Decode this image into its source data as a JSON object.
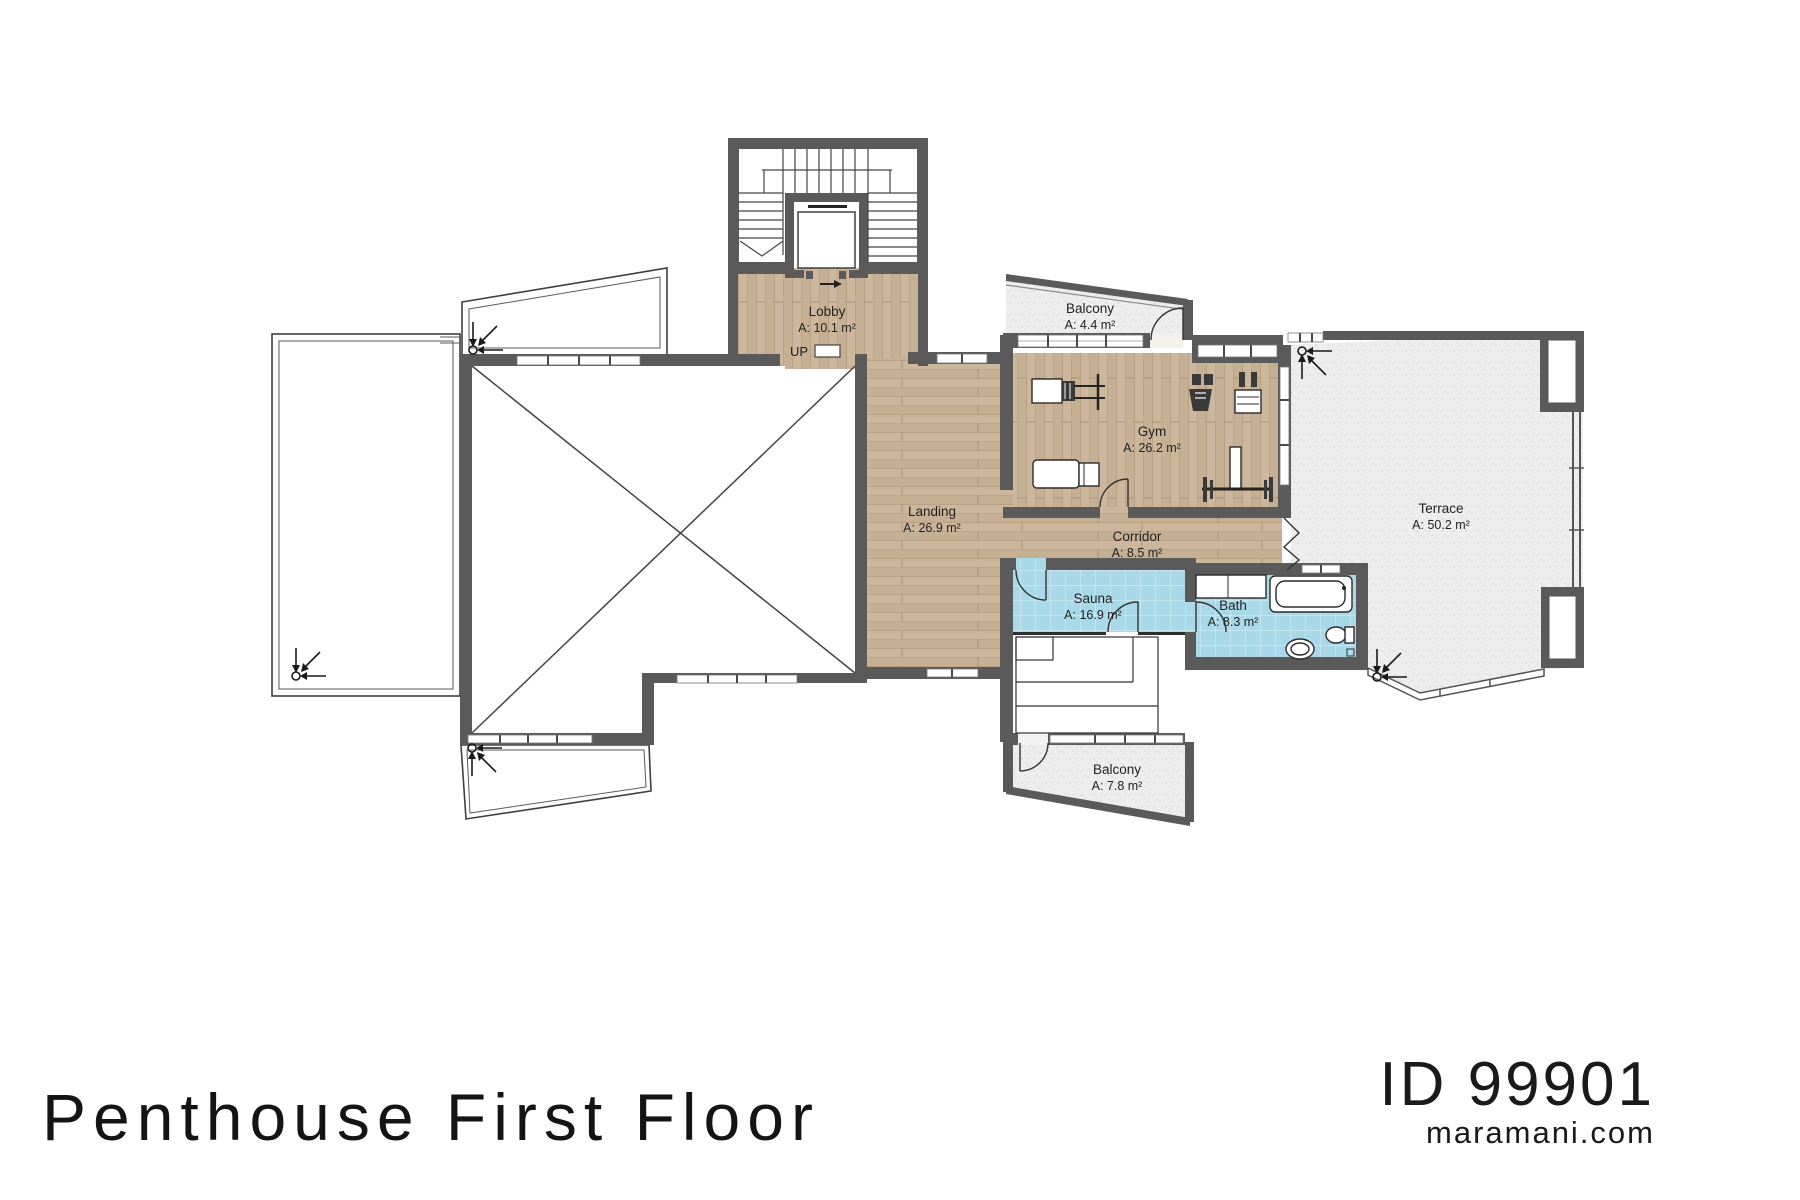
{
  "document": {
    "title": "Penthouse First Floor",
    "plan_id": "ID 99901",
    "website": "maramani.com"
  },
  "plan": {
    "stair_direction_label": "UP",
    "rooms": [
      {
        "name": "Lobby",
        "area": "A: 10.1 m²"
      },
      {
        "name": "Balcony",
        "area": "A: 4.4 m²"
      },
      {
        "name": "Gym",
        "area": "A: 26.2 m²"
      },
      {
        "name": "Landing",
        "area": "A: 26.9 m²"
      },
      {
        "name": "Corridor",
        "area": "A: 8.5 m²"
      },
      {
        "name": "Terrace",
        "area": "A: 50.2 m²"
      },
      {
        "name": "Sauna",
        "area": "A: 16.9 m²"
      },
      {
        "name": "Bath",
        "area": "A: 8.3 m²"
      },
      {
        "name": "Balcony",
        "area": "A: 7.8 m²"
      }
    ],
    "colors": {
      "wall": "#5a5a5a",
      "wood_floor": "#cdb79c",
      "tile_floor": "#a9d8e8",
      "concrete_floor": "#ededed",
      "outline": "#3f3f3f"
    }
  }
}
